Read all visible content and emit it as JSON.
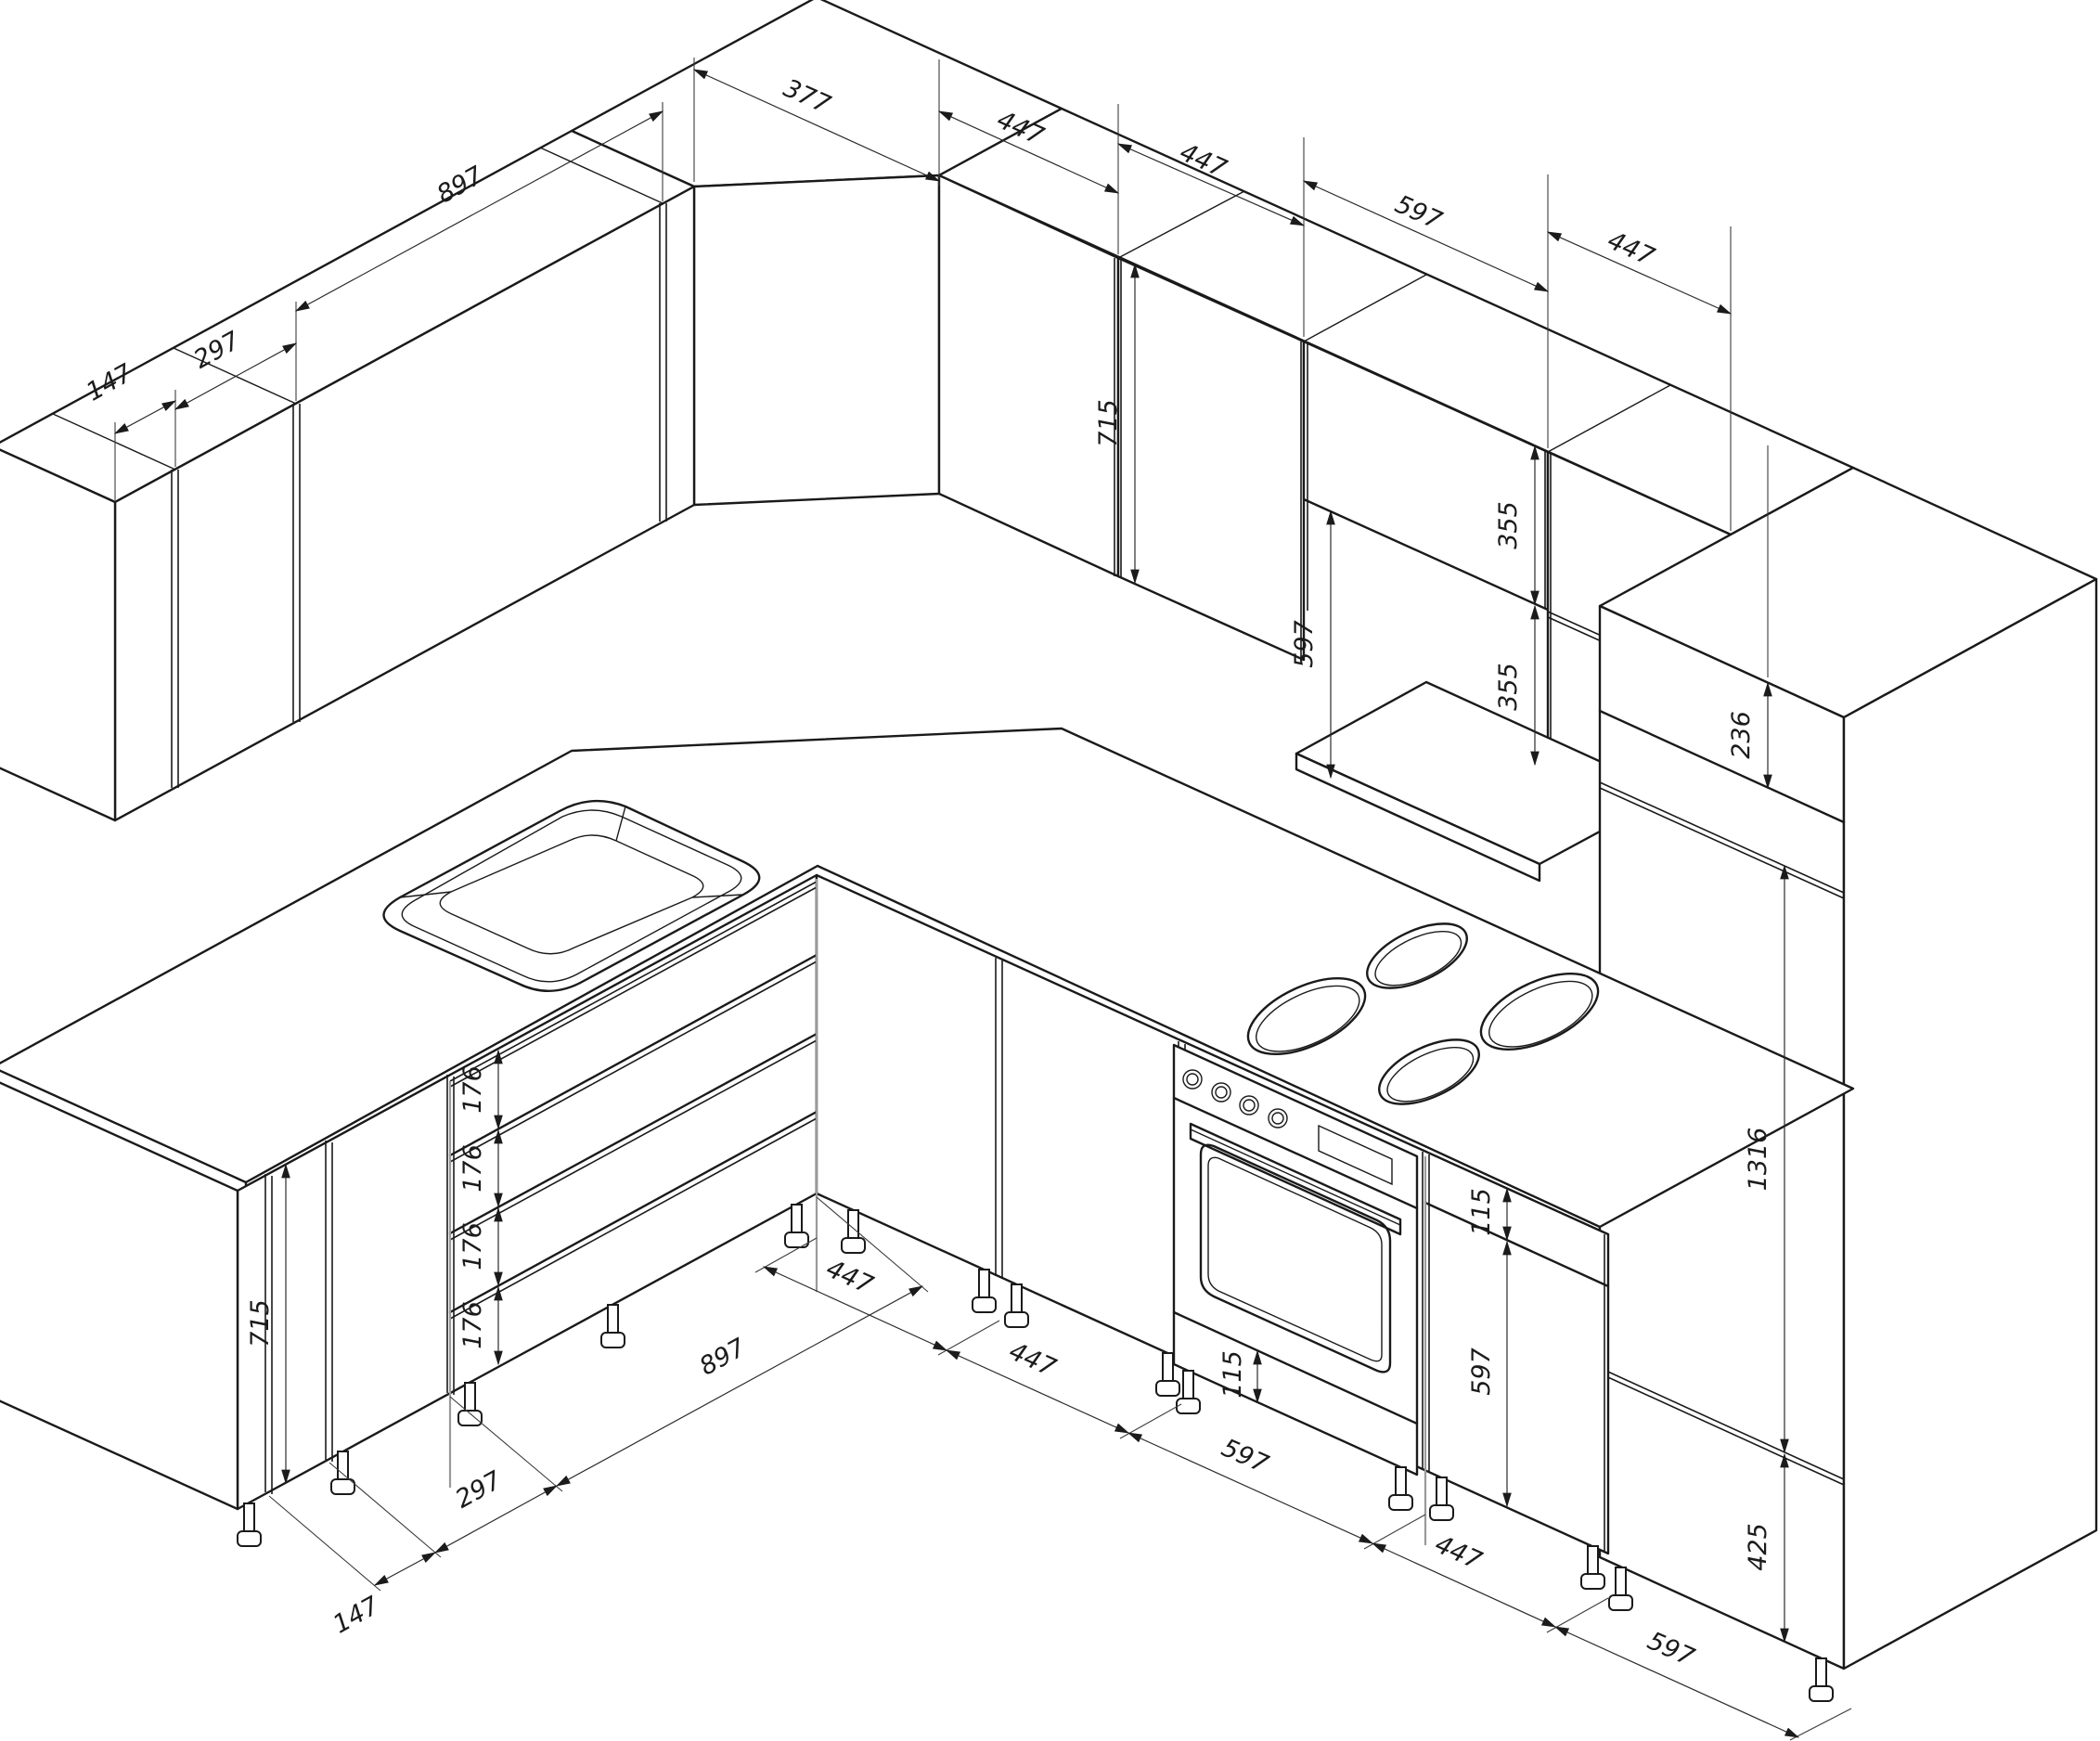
{
  "dims": {
    "top_back": [
      "377",
      "447",
      "447",
      "597",
      "447"
    ],
    "top_left": [
      "897",
      "297",
      "147"
    ],
    "wall": {
      "door_height": "715",
      "hood_gap": "597",
      "split_top": "355",
      "split_bottom": "355",
      "tall_top_box": "236"
    },
    "tall": {
      "main_door": "1316",
      "bottom_door": "425"
    },
    "drawer_heights": [
      "176",
      "176",
      "176",
      "176"
    ],
    "base_left_door": "715",
    "bottom_left": [
      "897",
      "297",
      "147"
    ],
    "cab_right": {
      "top_strip": "115",
      "door": "597"
    },
    "oven_strip": "115",
    "bottom_right": [
      "447",
      "447",
      "597",
      "447",
      "597"
    ]
  }
}
